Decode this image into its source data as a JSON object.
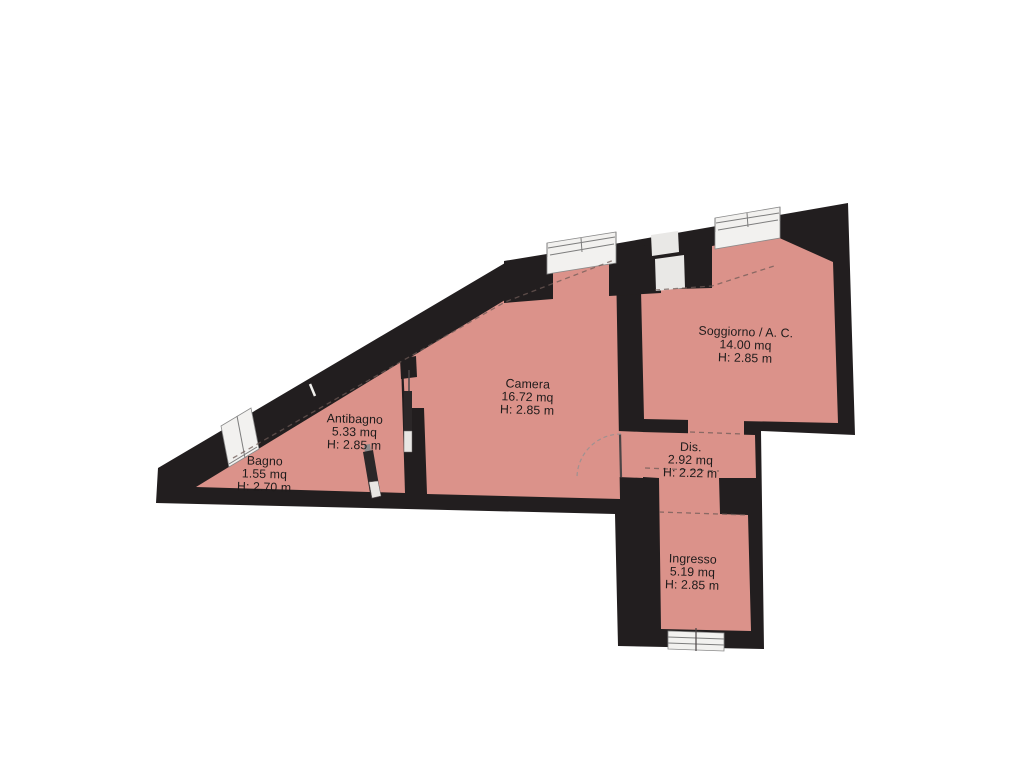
{
  "plan": {
    "type": "apartment-floor-plan",
    "rooms": [
      {
        "id": "bagno",
        "name": "Bagno",
        "area": "1.55 mq",
        "height": "H: 2.70 m"
      },
      {
        "id": "antibagno",
        "name": "Antibagno",
        "area": "5.33 mq",
        "height": "H: 2.85 m"
      },
      {
        "id": "camera",
        "name": "Camera",
        "area": "16.72 mq",
        "height": "H: 2.85 m"
      },
      {
        "id": "soggiorno",
        "name": "Soggiorno / A. C.",
        "area": "14.00 mq",
        "height": "H: 2.85 m"
      },
      {
        "id": "dis",
        "name": "Dis.",
        "area": "2.92 mq",
        "height": "H: 2.22 m"
      },
      {
        "id": "ingresso",
        "name": "Ingresso",
        "area": "5.19 mq",
        "height": "H: 2.85 m"
      }
    ],
    "colors": {
      "wall": "#221e1f",
      "floor": "#db928a",
      "window": "#f2f1ef",
      "background": "#ffffff"
    }
  }
}
